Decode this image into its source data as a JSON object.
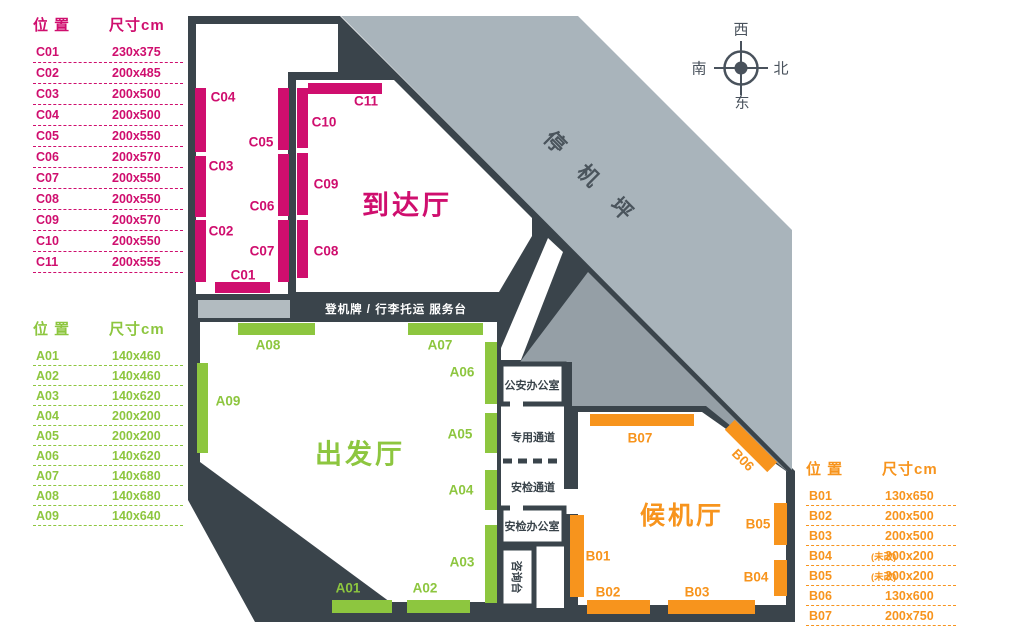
{
  "legend_c": {
    "col_pos": "位 置",
    "col_size": "尺寸cm",
    "color": "#cf0e6e",
    "rows": [
      {
        "pos": "C01",
        "note": "",
        "size": "230x375"
      },
      {
        "pos": "C02",
        "note": "",
        "size": "200x485"
      },
      {
        "pos": "C03",
        "note": "",
        "size": "200x500"
      },
      {
        "pos": "C04",
        "note": "",
        "size": "200x500"
      },
      {
        "pos": "C05",
        "note": "",
        "size": "200x550"
      },
      {
        "pos": "C06",
        "note": "",
        "size": "200x570"
      },
      {
        "pos": "C07",
        "note": "",
        "size": "200x550"
      },
      {
        "pos": "C08",
        "note": "",
        "size": "200x550"
      },
      {
        "pos": "C09",
        "note": "",
        "size": "200x570"
      },
      {
        "pos": "C10",
        "note": "",
        "size": "200x550"
      },
      {
        "pos": "C11",
        "note": "",
        "size": "200x555"
      }
    ]
  },
  "legend_a": {
    "col_pos": "位 置",
    "col_size": "尺寸cm",
    "color": "#8dc63f",
    "rows": [
      {
        "pos": "A01",
        "note": "",
        "size": "140x460"
      },
      {
        "pos": "A02",
        "note": "",
        "size": "140x460"
      },
      {
        "pos": "A03",
        "note": "",
        "size": "140x620"
      },
      {
        "pos": "A04",
        "note": "",
        "size": "200x200"
      },
      {
        "pos": "A05",
        "note": "",
        "size": "200x200"
      },
      {
        "pos": "A06",
        "note": "",
        "size": "140x620"
      },
      {
        "pos": "A07",
        "note": "",
        "size": "140x680"
      },
      {
        "pos": "A08",
        "note": "",
        "size": "140x680"
      },
      {
        "pos": "A09",
        "note": "",
        "size": "140x640"
      }
    ]
  },
  "legend_b": {
    "col_pos": "位 置",
    "col_size": "尺寸cm",
    "color": "#f7941d",
    "rows": [
      {
        "pos": "B01",
        "note": "",
        "size": "130x650"
      },
      {
        "pos": "B02",
        "note": "",
        "size": "200x500"
      },
      {
        "pos": "B03",
        "note": "",
        "size": "200x500"
      },
      {
        "pos": "B04",
        "note": "(未改)",
        "size": "200x200"
      },
      {
        "pos": "B05",
        "note": "(未改)",
        "size": "200x200"
      },
      {
        "pos": "B06",
        "note": "",
        "size": "130x600"
      },
      {
        "pos": "B07",
        "note": "",
        "size": "200x750"
      }
    ]
  },
  "compass": {
    "west": "西",
    "south": "南",
    "north": "北",
    "east": "东"
  },
  "halls": {
    "apron": "停机坪",
    "arrival": "到达厅",
    "departure": "出发厅",
    "waiting": "候机厅"
  },
  "service_bar": {
    "label": "登机牌 / 行李托运 服务台"
  },
  "rooms": {
    "police": "公安办公室",
    "special_passage": "专用通道",
    "security_passage": "安检通道",
    "security_office": "安检办公室",
    "info_desk": "咨询台"
  },
  "markers": {
    "c": [
      "C01",
      "C02",
      "C03",
      "C04",
      "C05",
      "C06",
      "C07",
      "C08",
      "C09",
      "C10",
      "C11"
    ],
    "a": [
      "A01",
      "A02",
      "A03",
      "A04",
      "A05",
      "A06",
      "A07",
      "A08",
      "A09"
    ],
    "b": [
      "B01",
      "B02",
      "B03",
      "B04",
      "B05",
      "B06",
      "B07"
    ]
  },
  "colors": {
    "c_accent": "#cf0e6e",
    "a_accent": "#8dc63f",
    "b_accent": "#f7941d",
    "wall": "#3a444b",
    "apron_gray": "#a9b4bb",
    "zone_gray": "#959fa6",
    "counter_gray": "#b2bbc0"
  }
}
